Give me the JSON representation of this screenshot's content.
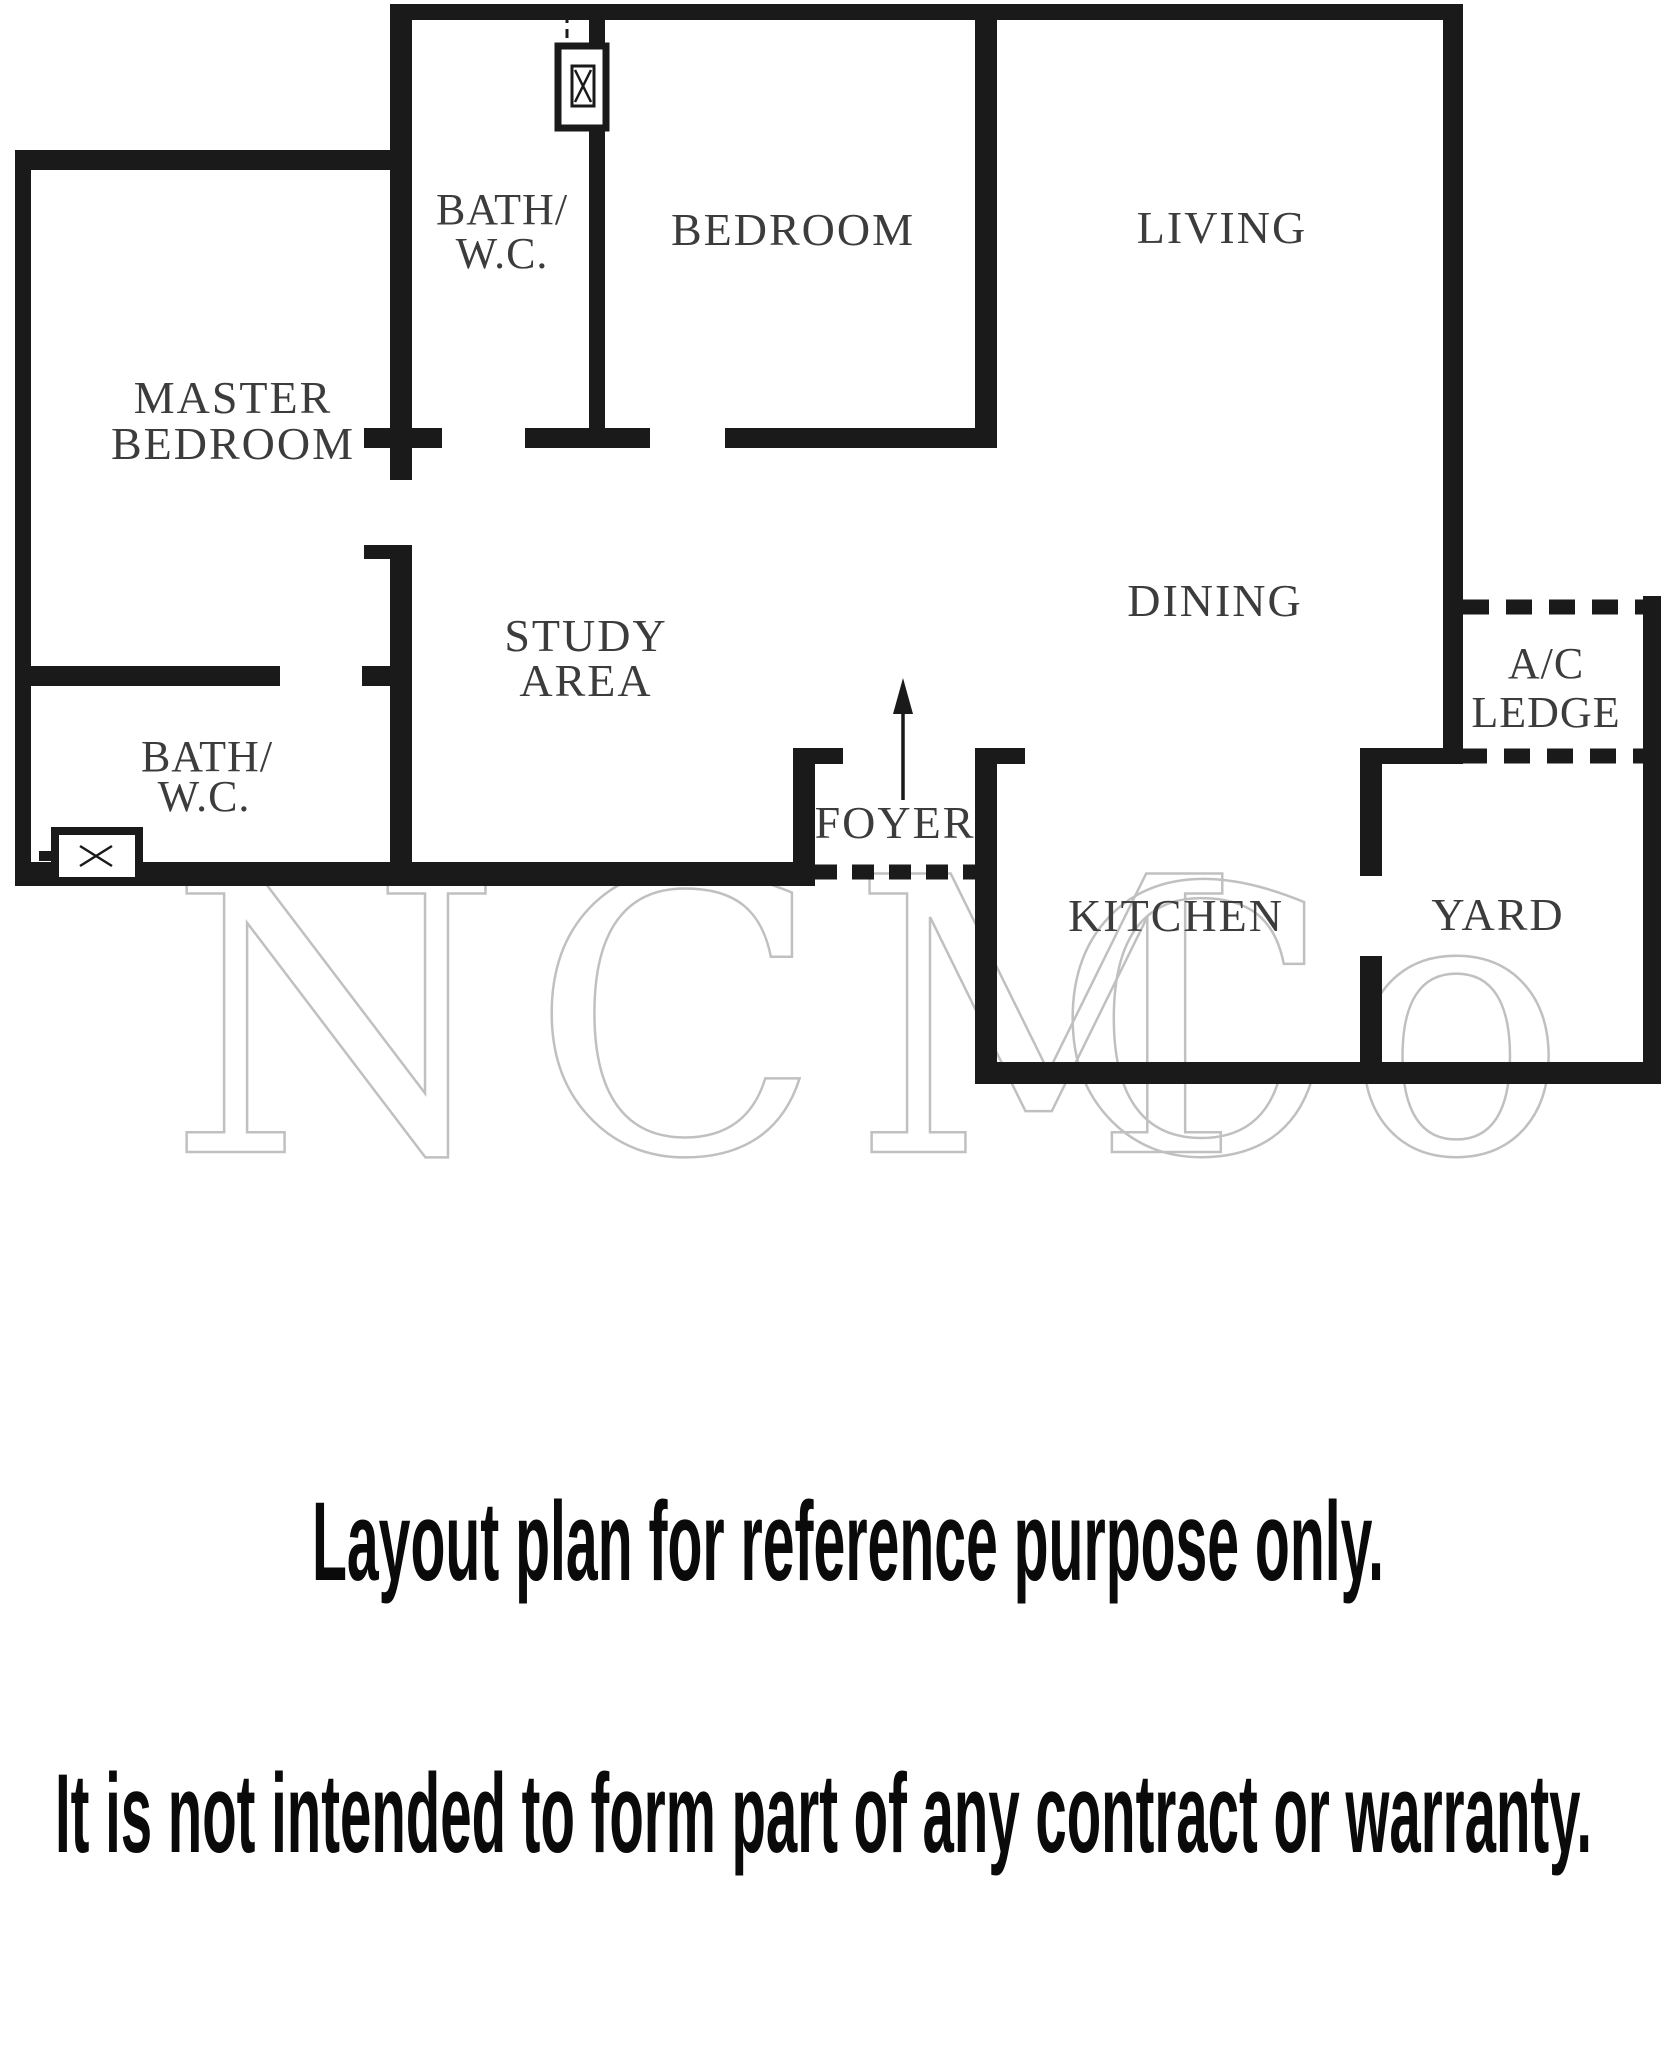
{
  "plan": {
    "labels": {
      "master_bedroom": [
        "MASTER",
        "BEDROOM"
      ],
      "bath_wc_top": [
        "BATH/",
        "W.C."
      ],
      "bedroom": "BEDROOM",
      "living": "LIVING",
      "study_area": [
        "STUDY",
        "AREA"
      ],
      "dining": "DINING",
      "ac_ledge": [
        "A/C",
        "LEDGE"
      ],
      "bath_wc_lower": [
        "BATH/",
        "W.C."
      ],
      "foyer": "FOYER",
      "kitchen": "KITCHEN",
      "yard": "YARD"
    },
    "icons": {
      "entrance_arrow": "up-arrow",
      "duct_fixture": "service-duct-with-x-mark",
      "window_fixture": "window-with-x-mark"
    },
    "colors": {
      "wall": "#1a1a1a",
      "room_label": "#3c3c3c",
      "watermark_stroke": "#c0c0c0",
      "disclaimer_text": "#0a0a0a",
      "background": "#ffffff"
    }
  },
  "watermark": {
    "left": "NCM",
    "right": "Co"
  },
  "disclaimer": {
    "line1": "Layout plan for reference purpose only.",
    "line2": "It is not intended to form part of any contract or warranty."
  }
}
